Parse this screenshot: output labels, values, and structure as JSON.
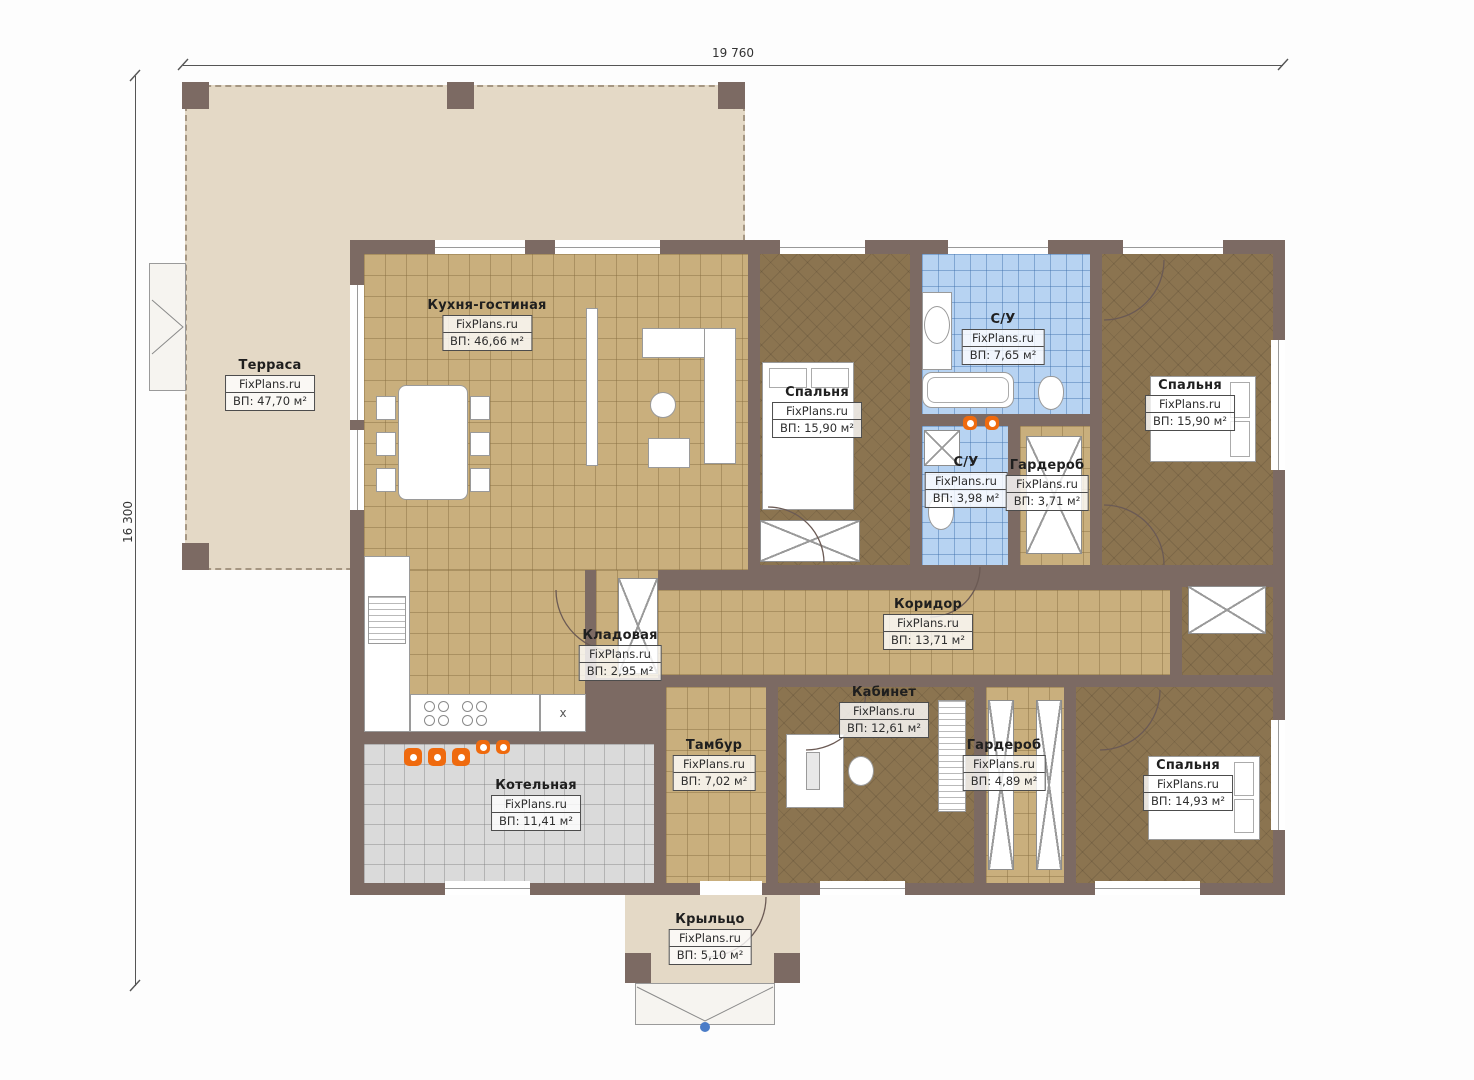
{
  "meta": {
    "watermark": "FixPlans.ru",
    "plan_type": "floor-plan"
  },
  "dimensions": {
    "top": "19 760",
    "left": "16 300"
  },
  "symbols": {
    "cabinet_x": "x"
  },
  "colors": {
    "wall": "#7c6a63",
    "terrace_floor": "#e4d9c6",
    "wood_tile": "#c9af7d",
    "bedroom_floor": "#8b7450",
    "bathroom_tile": "#b7d3f2",
    "boiler_tile": "#dadada",
    "fixture_orange": "#ef6a0e",
    "entry_marker_blue": "#4a7cc7"
  },
  "rooms": [
    {
      "id": "terrace",
      "name": "Терраса",
      "watermark": "FixPlans.ru",
      "area": "ВП: 47,70 м²"
    },
    {
      "id": "kitchen",
      "name": "Кухня-гостиная",
      "watermark": "FixPlans.ru",
      "area": "ВП: 46,66 м²"
    },
    {
      "id": "bedroom1",
      "name": "Спальня",
      "watermark": "FixPlans.ru",
      "area": "ВП: 15,90 м²"
    },
    {
      "id": "bath1",
      "name": "С/У",
      "watermark": "FixPlans.ru",
      "area": "ВП: 7,65 м²"
    },
    {
      "id": "bedroom2",
      "name": "Спальня",
      "watermark": "FixPlans.ru",
      "area": "ВП: 15,90 м²"
    },
    {
      "id": "bath2",
      "name": "С/У",
      "watermark": "FixPlans.ru",
      "area": "ВП: 3,98 м²"
    },
    {
      "id": "wardrobe1",
      "name": "Гардероб",
      "watermark": "FixPlans.ru",
      "area": "ВП: 3,71 м²"
    },
    {
      "id": "corridor",
      "name": "Коридор",
      "watermark": "FixPlans.ru",
      "area": "ВП: 13,71 м²"
    },
    {
      "id": "pantry",
      "name": "Кладовая",
      "watermark": "FixPlans.ru",
      "area": "ВП: 2,95 м²"
    },
    {
      "id": "office",
      "name": "Кабинет",
      "watermark": "FixPlans.ru",
      "area": "ВП: 12,61 м²"
    },
    {
      "id": "tambour",
      "name": "Тамбур",
      "watermark": "FixPlans.ru",
      "area": "ВП: 7,02 м²"
    },
    {
      "id": "wardrobe2",
      "name": "Гардероб",
      "watermark": "FixPlans.ru",
      "area": "ВП: 4,89 м²"
    },
    {
      "id": "bedroom3",
      "name": "Спальня",
      "watermark": "FixPlans.ru",
      "area": "ВП: 14,93 м²"
    },
    {
      "id": "boiler",
      "name": "Котельная",
      "watermark": "FixPlans.ru",
      "area": "ВП: 11,41 м²"
    },
    {
      "id": "porch",
      "name": "Крыльцо",
      "watermark": "FixPlans.ru",
      "area": "ВП: 5,10 м²"
    }
  ]
}
